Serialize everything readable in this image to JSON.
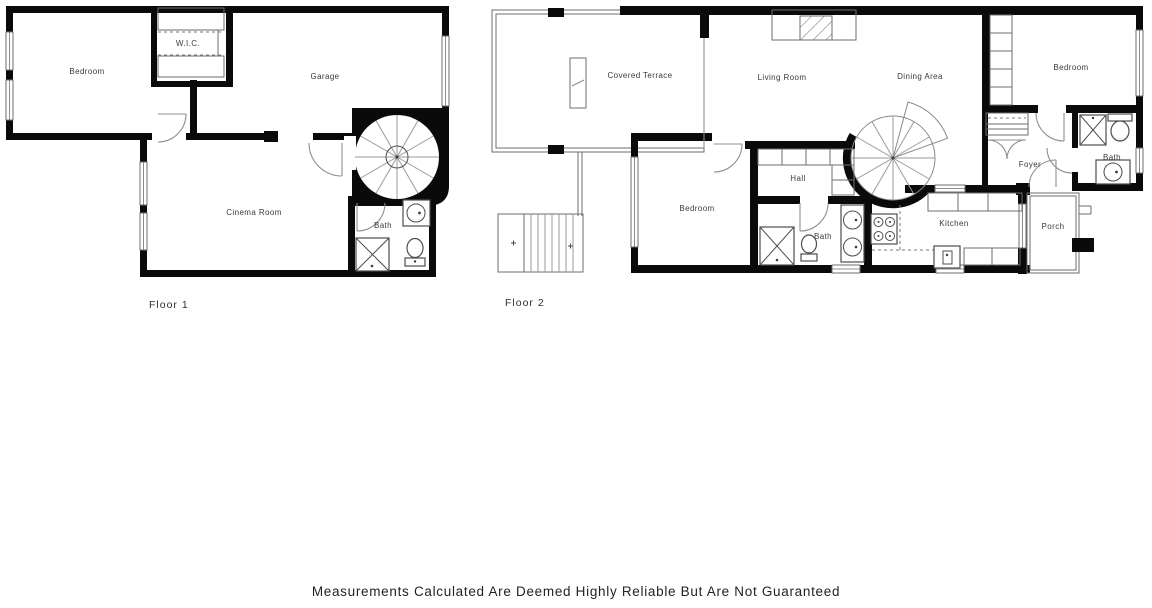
{
  "colors": {
    "background": "#ffffff",
    "walls": "#0a0a0a",
    "thin_lines": "#6e6e6e",
    "label_text": "#3a3a3a",
    "disclaimer_text": "#232323"
  },
  "symbols": {
    "shower": "x-box",
    "toilet": "oval-with-tank",
    "sink": "circle-in-square",
    "stove": "four-burners",
    "spiral_stairs": "radial-fan",
    "stairs": "parallel-treads",
    "door": "quarter-arc",
    "window": "double-line",
    "closet": "hatched-strip",
    "fireplace": "hatched-box"
  },
  "floor1": {
    "label": "Floor 1",
    "rooms": {
      "bedroom": "Bedroom",
      "wic": "W.I.C.",
      "garage": "Garage",
      "cinema_room": "Cinema Room",
      "bath": "Bath"
    }
  },
  "floor2": {
    "label": "Floor 2",
    "rooms": {
      "covered_terrace": "Covered Terrace",
      "living_room": "Living Room",
      "dining_area": "Dining Area",
      "bedroom_top": "Bedroom",
      "bedroom_mid": "Bedroom",
      "hall": "Hall",
      "bath_right": "Bath",
      "bath_mid": "Bath",
      "foyer": "Foyer",
      "kitchen": "Kitchen",
      "porch": "Porch"
    }
  },
  "footer": {
    "disclaimer": "Measurements Calculated Are Deemed Highly Reliable But Are Not Guaranteed"
  }
}
